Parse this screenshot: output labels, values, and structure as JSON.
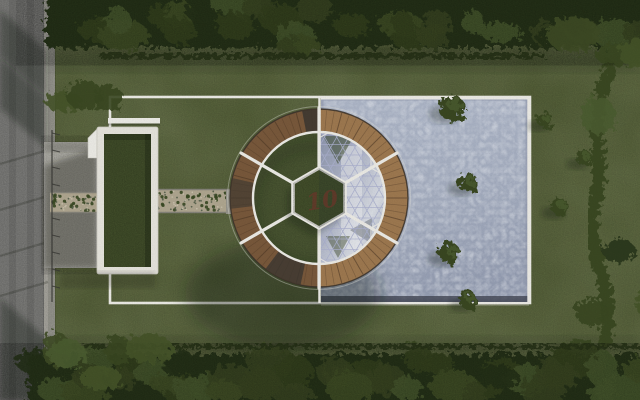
{
  "scene": {
    "center_mark": "10"
  },
  "colors": {
    "lawn": "#5c683c",
    "lawnLight": "#7d8a52",
    "lawnDark": "#1c2610",
    "road": "#8b8b88",
    "curb": "#b5b3ab",
    "sidewalk": "#a3a29a",
    "concrete": "#bdbcb4",
    "gravel": "#b4ab94",
    "pool": "#a9b2c5",
    "poolDeep": "#99a2b6",
    "poolEdgeDark": "#3f4350",
    "white": "#f3f2ec",
    "deck": "#7c5b3d",
    "deckLight": "#a27c52",
    "plank": "#4c3725",
    "deckDark": "#3e3a33",
    "glassLow": "#8f98b0",
    "glassMid": "#b7bdcf",
    "glassHigh": "#e4e7ee",
    "glassFrame": "#b0b6d4",
    "glassGreen": "#3d4a2d",
    "innerGrass": "#55633a",
    "hexGrass": "#4f5d33",
    "roofGrass": "#4d5c32",
    "tree": "#3a4a24",
    "treeDark": "#2c371c",
    "treeLight": "#4e5e31",
    "hedge": "#2e3a1e",
    "mark": "#6b3a2c",
    "fence": "#3a3a36"
  }
}
